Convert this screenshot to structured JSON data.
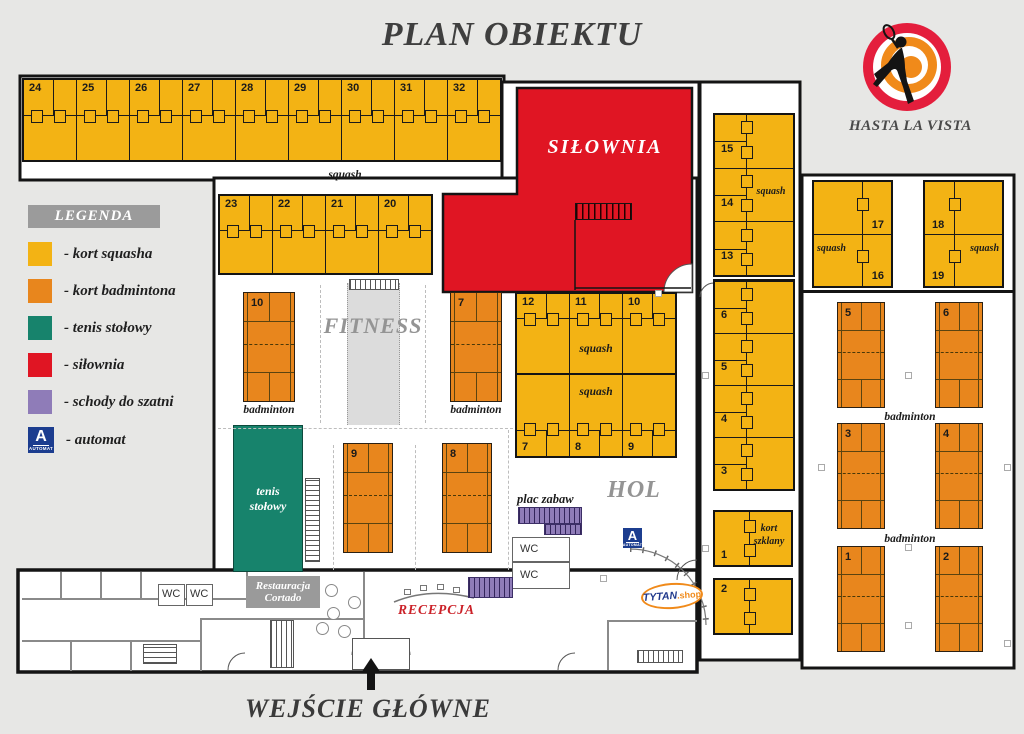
{
  "title": "PLAN OBIEKTU",
  "brand": {
    "name": "HASTA LA VISTA"
  },
  "legend": {
    "title": "LEGENDA",
    "items": [
      {
        "label": "- kort squasha",
        "color": "#F3B314"
      },
      {
        "label": "- kort badmintona",
        "color": "#E8861D"
      },
      {
        "label": "- tenis stołowy",
        "color": "#17836C"
      },
      {
        "label": "- siłownia",
        "color": "#E01523"
      },
      {
        "label": "- schody do szatni",
        "color": "#8F7CB8"
      },
      {
        "label": "- automat",
        "color": "#1C3D8F"
      }
    ]
  },
  "automat": {
    "letter": "A",
    "caption": "AUTOMAT"
  },
  "shop": {
    "name": "TYTAN",
    "suffix": ".shop"
  },
  "rooms": {
    "silownia": "SIŁOWNIA",
    "fitness": "FITNESS",
    "hol": "HOL",
    "tenis_stolowy": "tenis stołowy",
    "plac_zabaw": "plac zabaw",
    "restauracja": "Restauracja Cortado",
    "recepcja": "RECEPCJA",
    "wc": "WC",
    "kort_szklany": "kort szklany",
    "wejscie": "WEJŚCIE GŁÓWNE"
  },
  "courts": {
    "squash_label": "squash",
    "badminton_label": "badminton",
    "top_row": [
      "24",
      "25",
      "26",
      "27",
      "28",
      "29",
      "30",
      "31",
      "32"
    ],
    "second_row": [
      "23",
      "22",
      "21",
      "20"
    ],
    "strip_upper": [
      "15",
      "14",
      "13"
    ],
    "strip_lower": [
      "6",
      "5",
      "4",
      "3"
    ],
    "mid_top": [
      "12",
      "11",
      "10"
    ],
    "mid_bottom": [
      "7",
      "8",
      "9"
    ],
    "right_block_a": [
      "17",
      "16"
    ],
    "right_block_b": [
      "18",
      "19"
    ],
    "glass_court_number": "1",
    "court_two_number": "2",
    "badminton_right": [
      "5",
      "6",
      "3",
      "4",
      "1",
      "2"
    ],
    "badminton_mid": [
      "10",
      "7",
      "9",
      "8"
    ]
  }
}
